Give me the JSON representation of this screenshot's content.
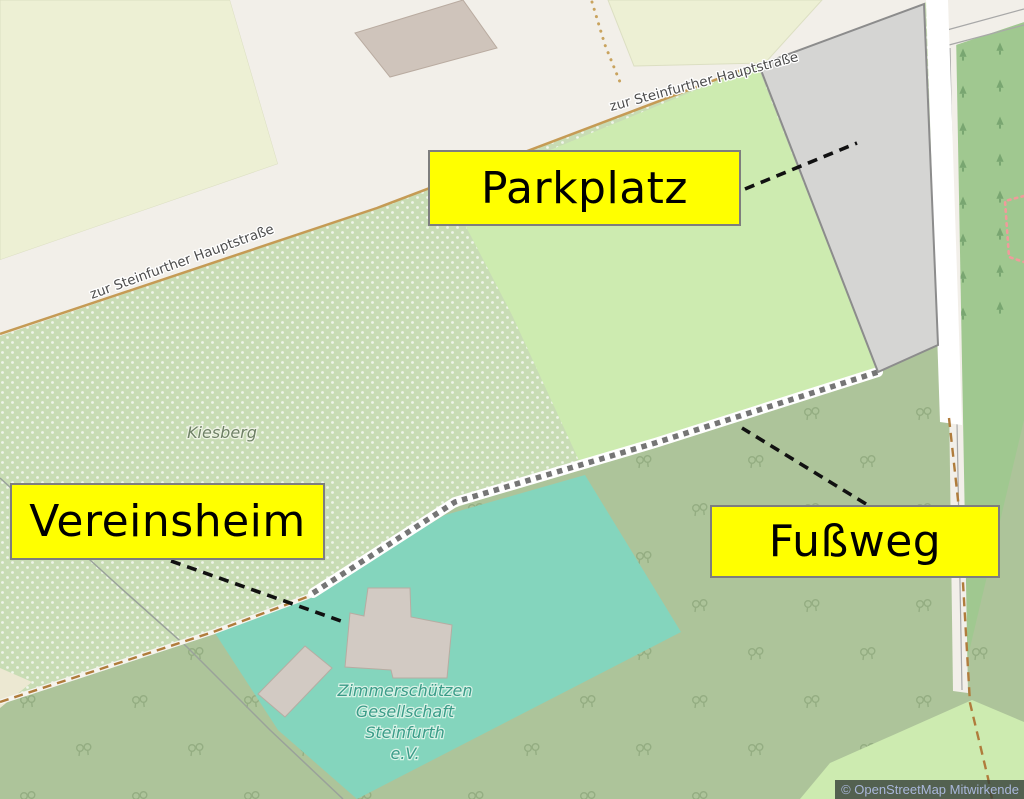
{
  "annotations": {
    "parkplatz": "Parkplatz",
    "vereinsheim": "Vereinsheim",
    "fussweg": "Fußweg"
  },
  "map_labels": {
    "street_upper": "zur Steinfurther Hauptstraße",
    "street_lower": "zur Steinfurther Hauptstraße",
    "hill": "Kiesberg",
    "club_line1": "Zimmerschützen",
    "club_line2": "Gesellschaft",
    "club_line3": "Steinfurth",
    "club_line4": "e.V."
  },
  "attribution": {
    "text": "© OpenStreetMap Mitwirkende"
  },
  "colors": {
    "annotation_fill": "#ffff00",
    "annotation_border": "#7e7e7e",
    "annotation_text": "#000000",
    "leader_line": "#111111",
    "meadow_dotted": "#c8dcb4",
    "meadow_bright": "#cdebb0",
    "farmland": "#edf0d4",
    "road": "#f2efe9",
    "road_casing": "#c59b55",
    "parking_fill": "#d5d5d3",
    "parking_stroke": "#8c8c8c",
    "forest": "#a0c890",
    "scrub": "#adc49a",
    "pitch": "#84d5bd",
    "building": "#d2cac3",
    "footpath_dash": "#757575",
    "track_dash": "#b07c3c",
    "boundary_pink": "#f09b9b",
    "attribution_bg": "#38423b",
    "attribution_text": "#a9b7da"
  }
}
